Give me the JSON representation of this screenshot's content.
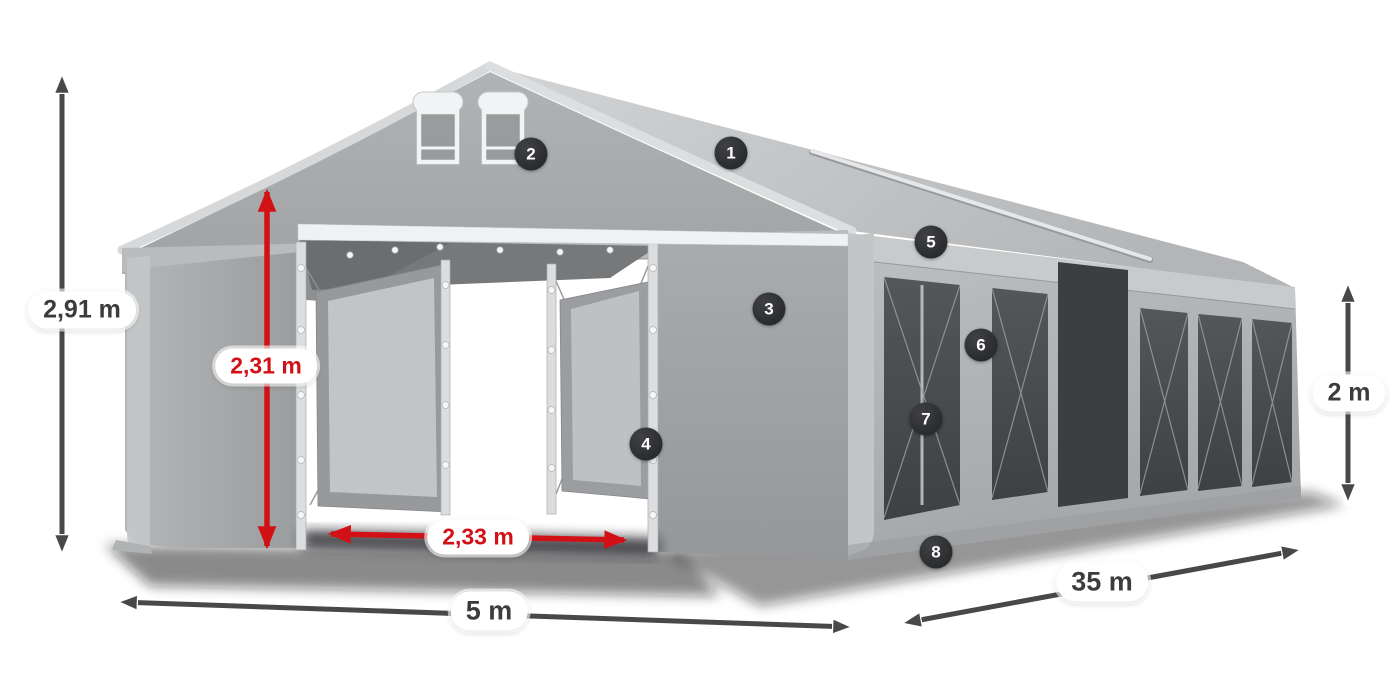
{
  "colors": {
    "background": "#ffffff",
    "dim_dark": "#47484a",
    "dim_red": "#d21117",
    "badge_bg": "#2a2b2d",
    "badge_text": "#ffffff",
    "pill_bg": "#ffffff",
    "pill_text_dark": "#3b3c3e",
    "tent_roof_light": "#cfd1d3",
    "tent_wall_mid": "#a8aaac",
    "tent_window_dark": "#4c4e51"
  },
  "dimensions": {
    "total_height": {
      "label": "2,91 m",
      "style": "dark"
    },
    "entrance_height": {
      "label": "2,31 m",
      "style": "red"
    },
    "entrance_width": {
      "label": "2,33 m",
      "style": "red"
    },
    "front_width": {
      "label": "5 m",
      "style": "dark"
    },
    "side_length": {
      "label": "35 m",
      "style": "dark"
    },
    "side_height": {
      "label": "2 m",
      "style": "dark"
    }
  },
  "callouts": [
    {
      "number": "1"
    },
    {
      "number": "2"
    },
    {
      "number": "3"
    },
    {
      "number": "4"
    },
    {
      "number": "5"
    },
    {
      "number": "6"
    },
    {
      "number": "7"
    },
    {
      "number": "8"
    }
  ]
}
